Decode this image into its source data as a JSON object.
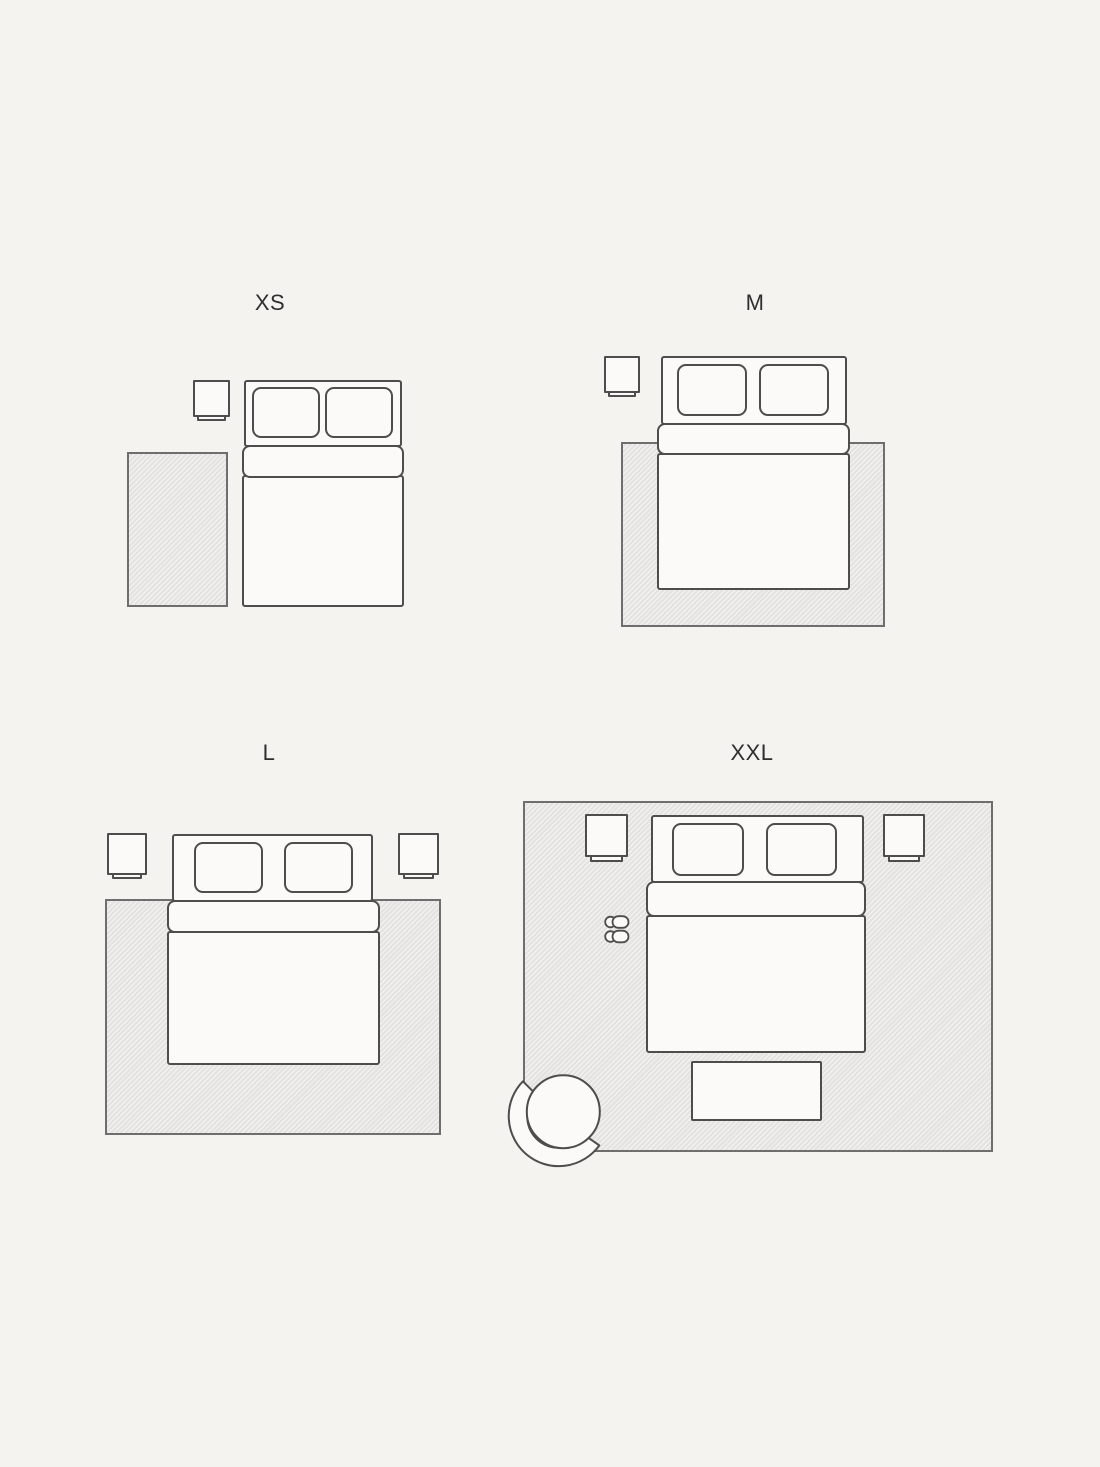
{
  "page": {
    "width": 1100,
    "height": 1467,
    "background": "#f4f3f0"
  },
  "colors": {
    "outline": "#4d4d4d",
    "furniture_fill": "#fbfaf8",
    "rug_fill": "#e4e3e1",
    "rug_hatch": "#ffffff",
    "rug_border": "#6e6e6e",
    "label_text": "#2f2f2f"
  },
  "panels": [
    {
      "id": "xs",
      "label": "XS"
    },
    {
      "id": "m",
      "label": "M"
    },
    {
      "id": "l",
      "label": "L"
    },
    {
      "id": "xxl",
      "label": "XXL"
    }
  ]
}
